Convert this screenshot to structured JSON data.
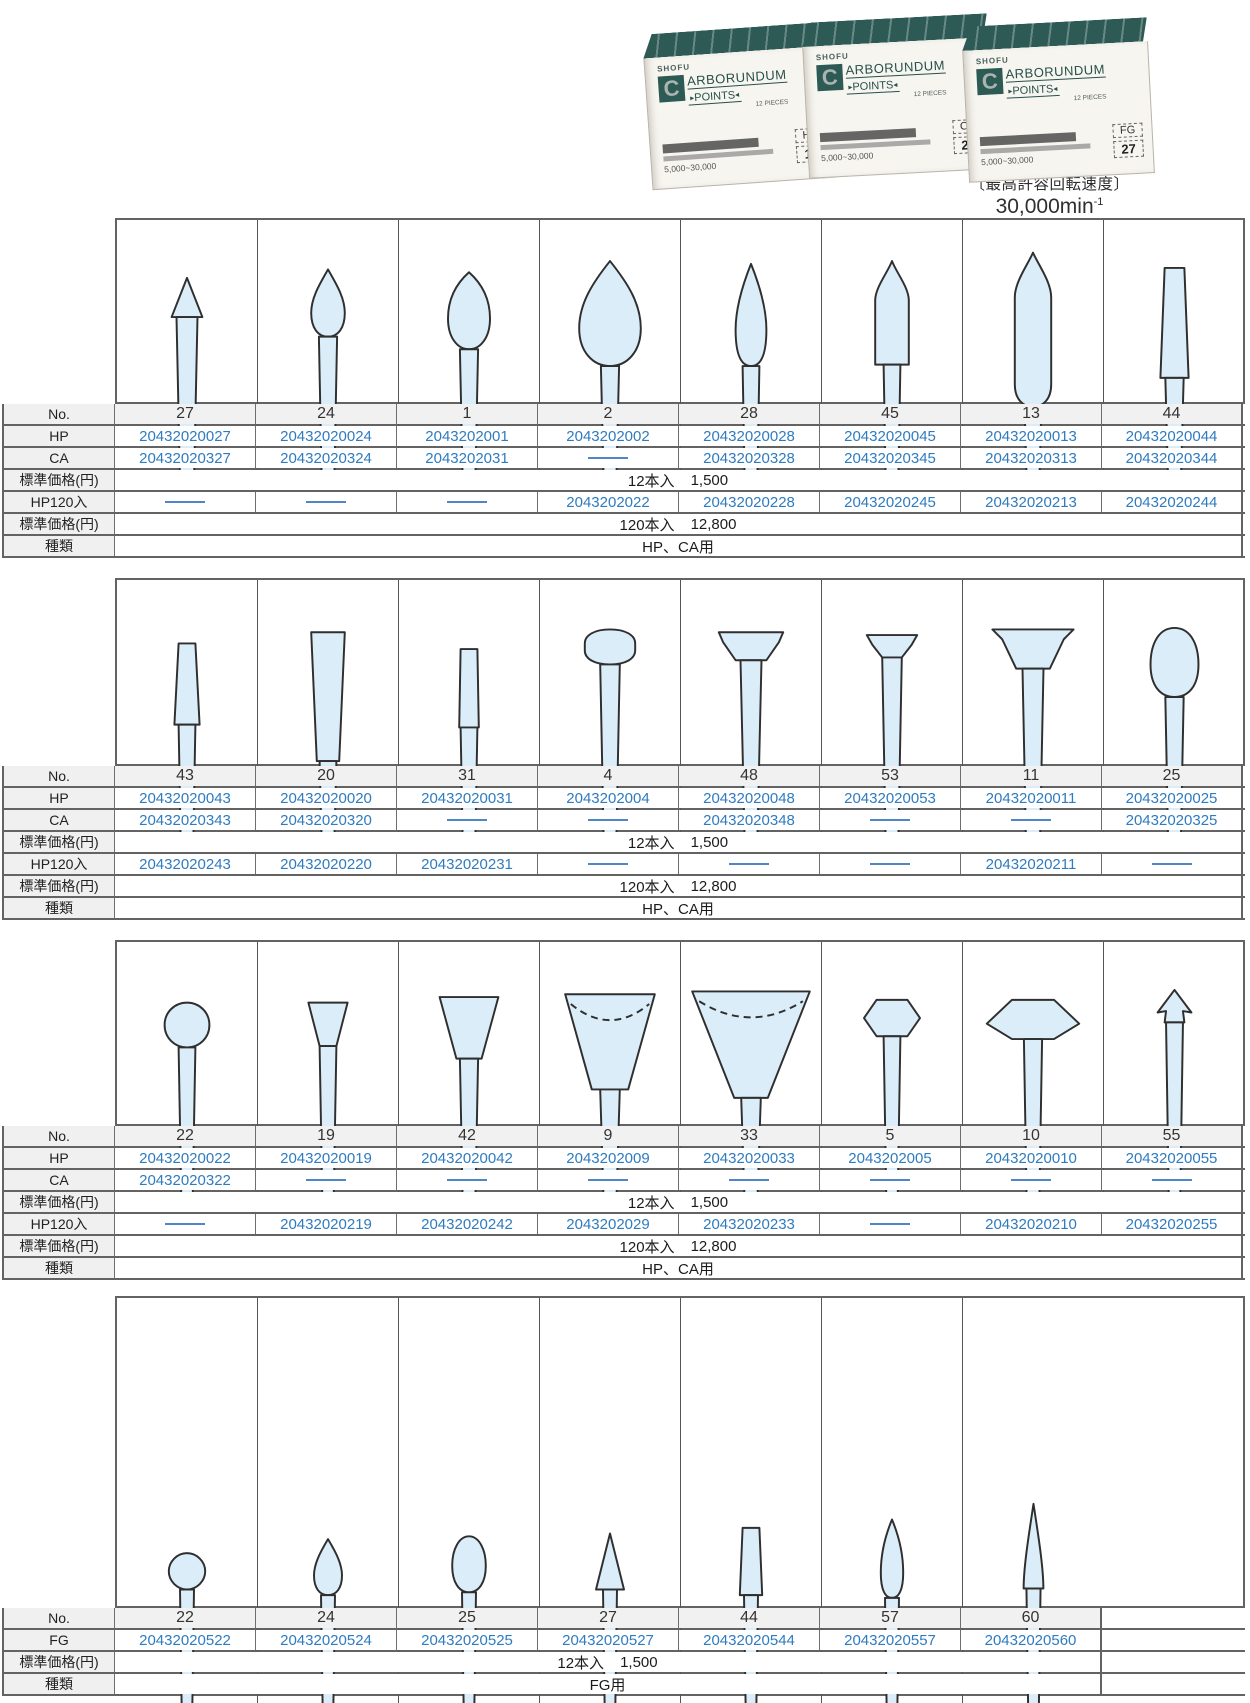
{
  "header": {
    "max_speed_label": "〔最高許容回転速度〕",
    "max_speed_value": "30,000min",
    "max_speed_exp": "-1"
  },
  "colors": {
    "code_blue": "#2e7bbf",
    "box_teal": "#2d5a54",
    "shape_fill": "#daedf8"
  },
  "product_photo": {
    "brand": "SHOFU",
    "logo_letter": "C",
    "title_line1": "ARBORUNDUM",
    "title_line2": "POINTS",
    "pieces_note": "12 PIECES",
    "speed_note": "5,000~30,000",
    "boxes": [
      {
        "type_label": "HP",
        "number": "11"
      },
      {
        "type_label": "CA",
        "number": "27"
      },
      {
        "type_label": "FG",
        "number": "27"
      }
    ]
  },
  "tables": [
    {
      "row_labels": {
        "no": "No.",
        "hp": "HP",
        "ca": "CA",
        "hp120": "HP120入",
        "price12": "標準価格(円)",
        "price120": "標準価格(円)",
        "kind": "種類"
      },
      "price12": {
        "qty": "12本入",
        "price": "1,500"
      },
      "price120": {
        "qty": "120本入",
        "price": "12,800"
      },
      "kind": "HP、CA用",
      "columns": [
        {
          "no": "27",
          "shape": "cone-tip",
          "hp": "20432020027",
          "ca": "20432020327",
          "hp120": null
        },
        {
          "no": "24",
          "shape": "teardrop-small",
          "hp": "20432020024",
          "ca": "20432020324",
          "hp120": null
        },
        {
          "no": "1",
          "shape": "teardrop",
          "hp": "2043202001",
          "ca": "2043202031",
          "hp120": null
        },
        {
          "no": "2",
          "shape": "teardrop-large",
          "hp": "2043202002",
          "ca": null,
          "hp120": "2043202022"
        },
        {
          "no": "28",
          "shape": "flame",
          "hp": "20432020028",
          "ca": "20432020328",
          "hp120": "20432020228"
        },
        {
          "no": "45",
          "shape": "bullet",
          "hp": "20432020045",
          "ca": "20432020345",
          "hp120": "20432020245"
        },
        {
          "no": "13",
          "shape": "torpedo",
          "hp": "20432020013",
          "ca": "20432020313",
          "hp120": "20432020213"
        },
        {
          "no": "44",
          "shape": "tapered-cylinder",
          "hp": "20432020044",
          "ca": "20432020344",
          "hp120": "20432020244"
        }
      ]
    },
    {
      "row_labels": {
        "no": "No.",
        "hp": "HP",
        "ca": "CA",
        "hp120": "HP120入",
        "price12": "標準価格(円)",
        "price120": "標準価格(円)",
        "kind": "種類"
      },
      "price12": {
        "qty": "12本入",
        "price": "1,500"
      },
      "price120": {
        "qty": "120本入",
        "price": "12,800"
      },
      "kind": "HP、CA用",
      "columns": [
        {
          "no": "43",
          "shape": "tapered-cylinder-small",
          "hp": "20432020043",
          "ca": "20432020343",
          "hp120": "20432020243"
        },
        {
          "no": "20",
          "shape": "tapered-cone",
          "hp": "20432020020",
          "ca": "20432020320",
          "hp120": "20432020220"
        },
        {
          "no": "31",
          "shape": "cylinder-small",
          "hp": "20432020031",
          "ca": null,
          "hp120": "20432020231"
        },
        {
          "no": "4",
          "shape": "mushroom-cap",
          "hp": "2043202004",
          "ca": null,
          "hp120": null
        },
        {
          "no": "48",
          "shape": "t-flat-wide",
          "hp": "20432020048",
          "ca": "20432020348",
          "hp120": null
        },
        {
          "no": "53",
          "shape": "t-flat-small",
          "hp": "20432020053",
          "ca": null,
          "hp120": null
        },
        {
          "no": "11",
          "shape": "t-wide-wheel",
          "hp": "20432020011",
          "ca": null,
          "hp120": "20432020211"
        },
        {
          "no": "25",
          "shape": "egg",
          "hp": "20432020025",
          "ca": "20432020325",
          "hp120": null
        }
      ]
    },
    {
      "row_labels": {
        "no": "No.",
        "hp": "HP",
        "ca": "CA",
        "hp120": "HP120入",
        "price12": "標準価格(円)",
        "price120": "標準価格(円)",
        "kind": "種類"
      },
      "price12": {
        "qty": "12本入",
        "price": "1,500"
      },
      "price120": {
        "qty": "120本入",
        "price": "12,800"
      },
      "kind": "HP、CA用",
      "columns": [
        {
          "no": "22",
          "shape": "ball",
          "hp": "20432020022",
          "ca": "20432020322",
          "hp120": null
        },
        {
          "no": "19",
          "shape": "inverted-cone-small",
          "hp": "20432020019",
          "ca": null,
          "hp120": "20432020219"
        },
        {
          "no": "42",
          "shape": "inverted-cone",
          "hp": "20432020042",
          "ca": null,
          "hp120": "20432020242"
        },
        {
          "no": "9",
          "shape": "cup",
          "hp": "2043202009",
          "ca": null,
          "hp120": "2043202029"
        },
        {
          "no": "33",
          "shape": "cup-wide",
          "hp": "20432020033",
          "ca": null,
          "hp120": "20432020233"
        },
        {
          "no": "5",
          "shape": "hex-wheel",
          "hp": "2043202005",
          "ca": null,
          "hp120": null
        },
        {
          "no": "10",
          "shape": "diamond-wheel",
          "hp": "20432020010",
          "ca": null,
          "hp120": "20432020210"
        },
        {
          "no": "55",
          "shape": "arrow-tip",
          "hp": "20432020055",
          "ca": null,
          "hp120": "20432020255"
        }
      ]
    },
    {
      "row_labels": {
        "no": "No.",
        "fg": "FG",
        "price12": "標準価格(円)",
        "kind": "種類"
      },
      "price12": {
        "qty": "12本入",
        "price": "1,500"
      },
      "kind": "FG用",
      "columns": [
        {
          "no": "22",
          "shape": "fg-ball",
          "fg": "20432020522"
        },
        {
          "no": "24",
          "shape": "fg-teardrop",
          "fg": "20432020524"
        },
        {
          "no": "25",
          "shape": "fg-egg",
          "fg": "20432020525"
        },
        {
          "no": "27",
          "shape": "fg-cone",
          "fg": "20432020527"
        },
        {
          "no": "44",
          "shape": "fg-cylinder",
          "fg": "20432020544"
        },
        {
          "no": "57",
          "shape": "fg-flame",
          "fg": "20432020557"
        },
        {
          "no": "60",
          "shape": "fg-long-cone",
          "fg": "20432020560"
        }
      ]
    }
  ]
}
